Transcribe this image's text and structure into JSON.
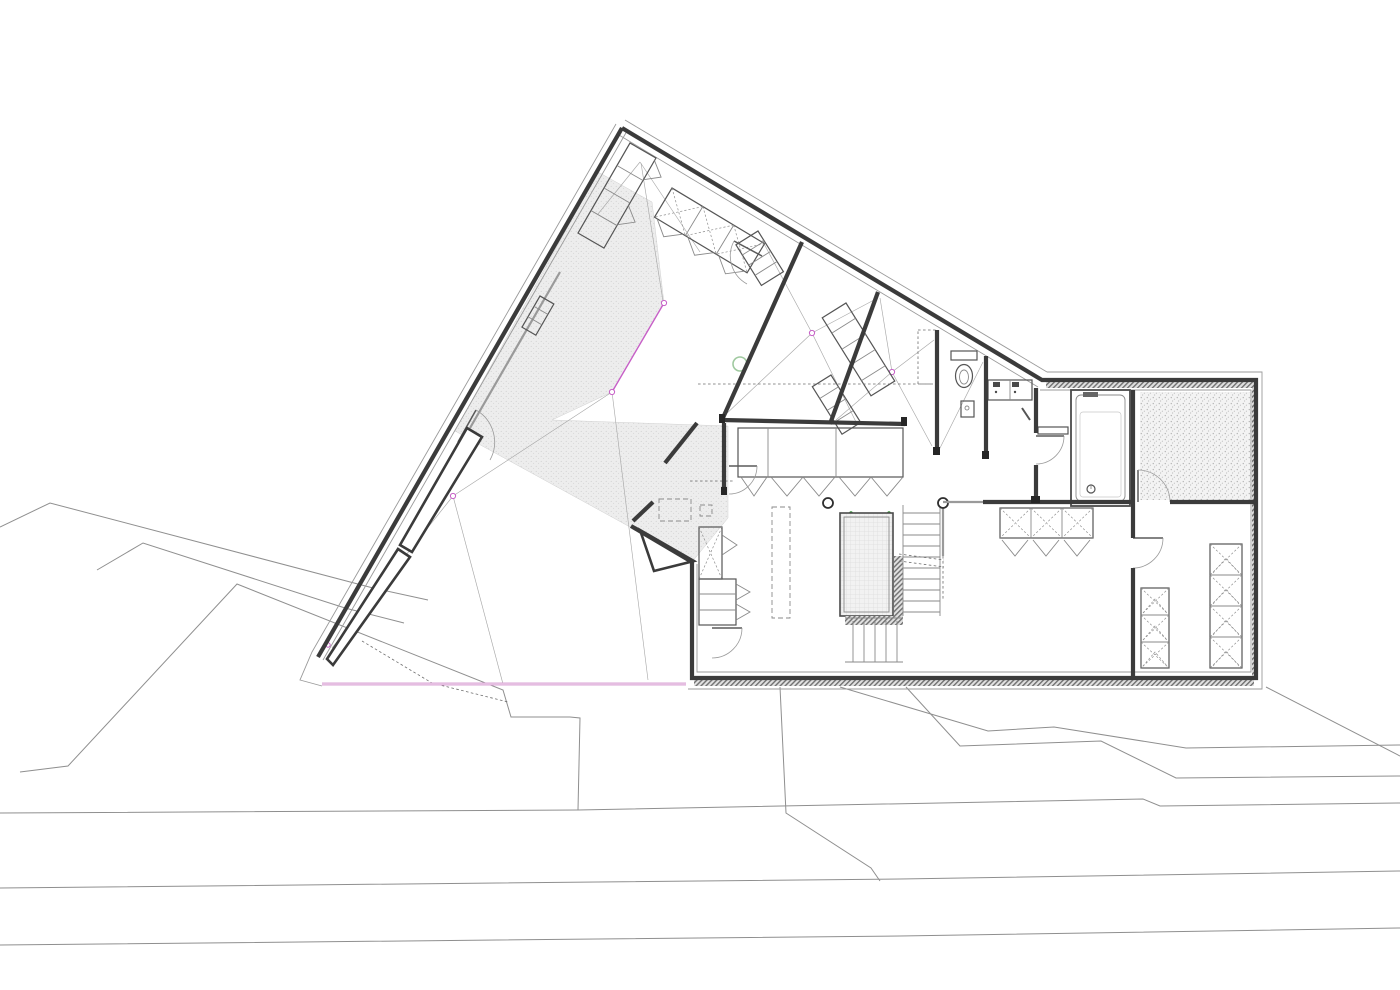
{
  "canvas": {
    "width": 1400,
    "height": 990,
    "background": "#ffffff"
  },
  "palette": {
    "wall": "#3b3b3b",
    "outline": "#9a9a9a",
    "site_line": "#8f8f8f",
    "fixture_line": "#555555",
    "light_line": "#8a8a8a",
    "terrace_edge_pink": "#d9a4d4",
    "ridge_magenta": "#c75fc7",
    "marker_green": "#2e8b2e",
    "circle_green": "#9fc99f"
  },
  "plan": {
    "type": "architectural-floor-plan",
    "features": [
      "site-context-lines",
      "road-edges",
      "terrace-edge-pink-line",
      "triangular-wing",
      "right-rectangular-wing",
      "void-stipple-hatch",
      "roof-fold-lines",
      "ridge-node-markers",
      "wedge-wall-slivers",
      "apex-closets",
      "cross-hatched-wardrobes",
      "corridor-wardrobe-row",
      "staircase",
      "glass-floor-panel",
      "columns",
      "kitchen-cabinets",
      "toilet",
      "double-sink",
      "bathtub",
      "gravel-room",
      "door-swings",
      "dashed-furniture-outlines",
      "insulation-hatch-strips"
    ]
  }
}
